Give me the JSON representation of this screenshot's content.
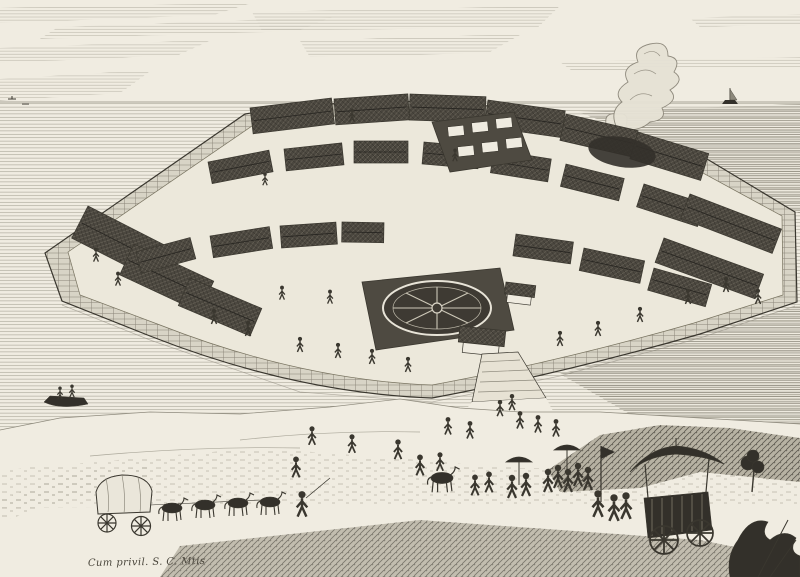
{
  "artwork": {
    "caption": "Cum privil. S. C. Mtis"
  },
  "colors": {
    "paper": "#f0ece1",
    "ink": "#3a372f",
    "ink2": "#8f8b7e",
    "roof": "#4b473f",
    "sea": "#a09c8e",
    "stone": "#d8d4c6",
    "court": "#ece8db",
    "dark": "#33302a"
  },
  "scene": {
    "sky": "hatched cloud bands",
    "sea": "harbour water",
    "island": "fan-shaped walled trading island",
    "warehouses": "rows of gabled warehouses",
    "star_garden": "circular star parterre garden",
    "parterre_garden": "formal garden beds",
    "smoke": "smoke plumes",
    "gate": "water gate with steps",
    "wagon": "covered wagon with horse team",
    "procession": "travellers with parasols",
    "carriage": "canopied carriage with attendants",
    "boat": "rowing boat",
    "ship": "sailing ship on horizon",
    "tree": "tree on hillock",
    "foliage": "foreground foliage"
  }
}
